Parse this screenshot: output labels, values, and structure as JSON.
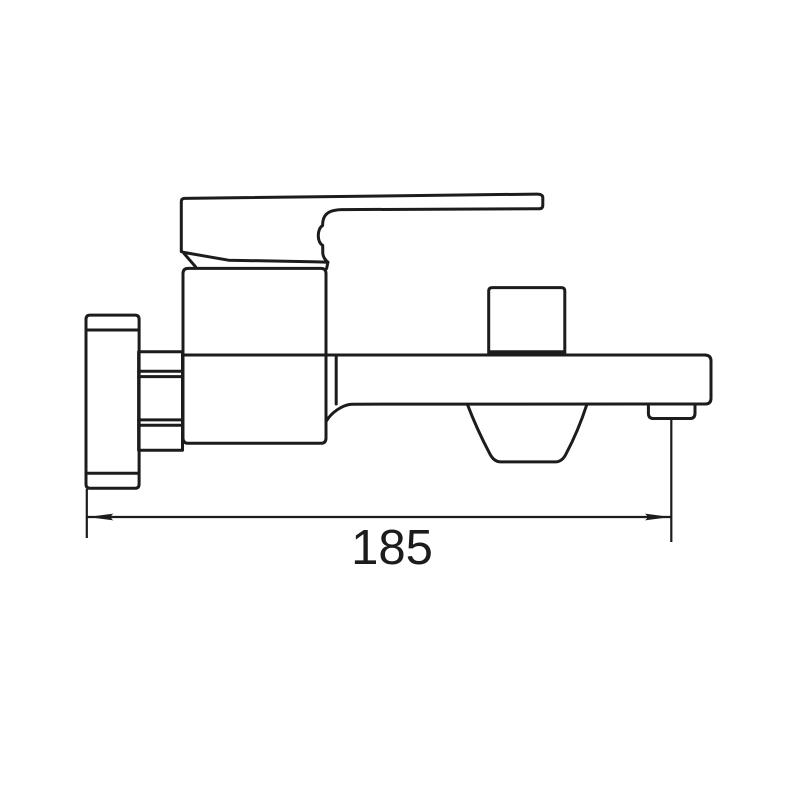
{
  "dimension": {
    "label": "185"
  },
  "colors": {
    "line": "#1c1c1c",
    "background": "#ffffff"
  },
  "icons": {
    "wall_flange": "wall-mount-flange-shape",
    "connector_nut": "mounting-nut-shape",
    "valve_body": "mixer-valve-body-shape",
    "handle_lever": "single-lever-handle-shape",
    "spout": "bath-spout-shape",
    "diverter_knob": "diverter-knob-shape",
    "aerator_shroud": "water-outlet-shroud-shape",
    "outlet_nozzle": "spout-end-nozzle-shape"
  }
}
